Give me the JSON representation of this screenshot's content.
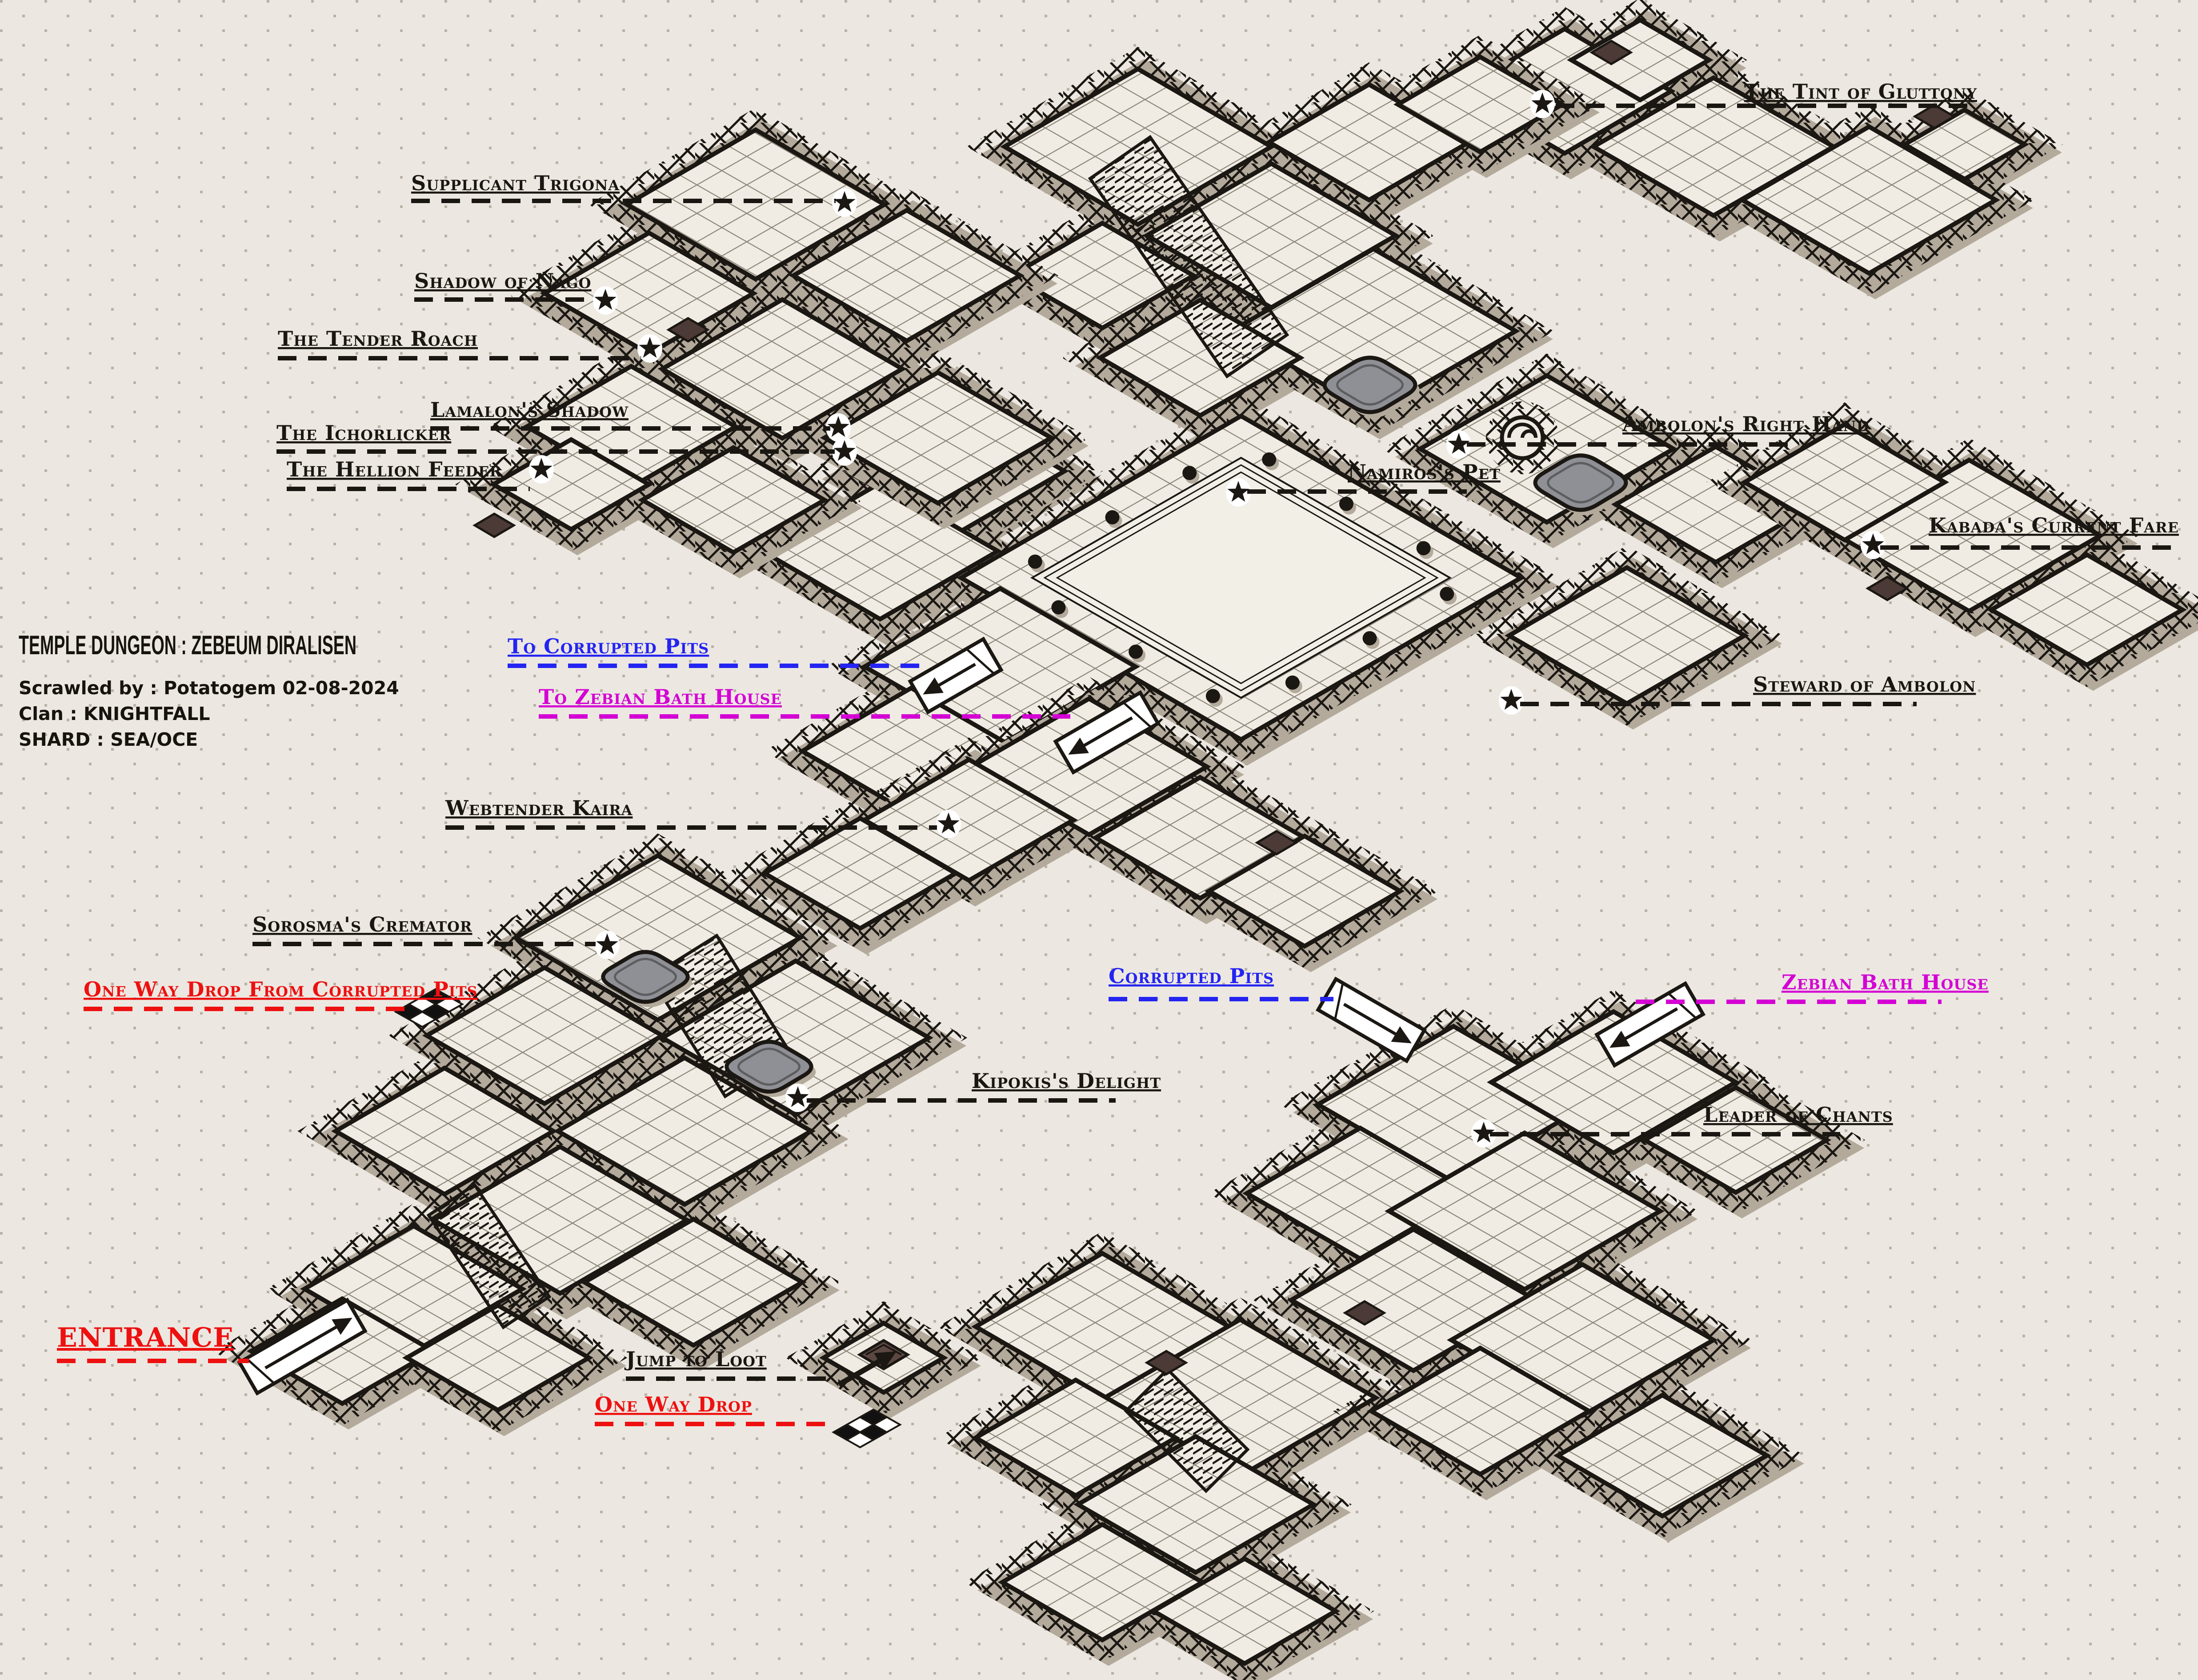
{
  "title_block": {
    "title": "TEMPLE DUNGEON : ZEBEUM DIRALISEN",
    "scrawled_by": "Scrawled by : Potatogem 02-08-2024",
    "clan": "Clan : KNIGHTFALL",
    "shard": "SHARD : SEA/OCE"
  },
  "colors": {
    "background": "#ece8e1",
    "floor": "#f0ece3",
    "ink": "#1b1713",
    "wall_shadow": "#b3aa9c",
    "pool_gray": "#8f9095",
    "label_black": "#1a1612",
    "label_red": "#ee1010",
    "label_blue": "#2424f2",
    "label_magenta": "#d400d4"
  },
  "labels": [
    {
      "id": "tint-of-gluttony",
      "text": "The Tint of Gluttony",
      "color": "#1a1612",
      "marker": "star"
    },
    {
      "id": "supplicant-trigona",
      "text": "Supplicant Trigona",
      "color": "#1a1612",
      "marker": "star"
    },
    {
      "id": "shadow-of-nago",
      "text": "Shadow of Nago",
      "color": "#1a1612",
      "marker": "star"
    },
    {
      "id": "tender-roach",
      "text": "The Tender Roach",
      "color": "#1a1612",
      "marker": "star"
    },
    {
      "id": "lamalons-shadow",
      "text": "Lamalon's Shadow",
      "color": "#1a1612",
      "marker": "star"
    },
    {
      "id": "ichorlicker",
      "text": "The Ichorlicker",
      "color": "#1a1612",
      "marker": "star"
    },
    {
      "id": "hellion-feeder",
      "text": "The Hellion Feeder",
      "color": "#1a1612",
      "marker": "star"
    },
    {
      "id": "ambolons-right-hand",
      "text": "Ambolon's Right Hand",
      "color": "#1a1612",
      "marker": "star"
    },
    {
      "id": "namiross-pet",
      "text": "Namiros's Pet",
      "color": "#1a1612",
      "marker": "star"
    },
    {
      "id": "kabadas-current-fare",
      "text": "Kabada's Current Fare",
      "color": "#1a1612",
      "marker": "star"
    },
    {
      "id": "to-corrupted-pits",
      "text": "To Corrupted Pits",
      "color": "#2424f2",
      "marker": "white-arrow"
    },
    {
      "id": "to-zebian-bath-house",
      "text": "To Zebian Bath House",
      "color": "#d400d4",
      "marker": "white-arrow"
    },
    {
      "id": "steward-of-ambolon",
      "text": "Steward of Ambolon",
      "color": "#1a1612",
      "marker": "star"
    },
    {
      "id": "webtender-kaira",
      "text": "Webtender Kaira",
      "color": "#1a1612",
      "marker": "star"
    },
    {
      "id": "sorosmas-cremator",
      "text": "Sorosma's Cremator",
      "color": "#1a1612",
      "marker": "star"
    },
    {
      "id": "one-way-drop-from-corrupted-pits",
      "text": "One Way Drop From Corrupted Pits",
      "color": "#ee1010",
      "marker": "checker-drop"
    },
    {
      "id": "corrupted-pits",
      "text": "Corrupted Pits",
      "color": "#2424f2",
      "marker": "white-arrow"
    },
    {
      "id": "zebian-bath-house",
      "text": "Zebian Bath House",
      "color": "#d400d4",
      "marker": "white-arrow"
    },
    {
      "id": "kipokiss-delight",
      "text": "Kipokis's Delight",
      "color": "#1a1612",
      "marker": "star"
    },
    {
      "id": "leader-of-chants",
      "text": "Leader of Chants",
      "color": "#1a1612",
      "marker": "star"
    },
    {
      "id": "entrance",
      "text": "ENTRANCE",
      "color": "#ee1010",
      "marker": "white-arrow"
    },
    {
      "id": "jump-to-loot",
      "text": "Jump to Loot",
      "color": "#1a1612",
      "marker": "black-arrow"
    },
    {
      "id": "one-way-drop",
      "text": "One Way Drop",
      "color": "#ee1010",
      "marker": "checker-drop"
    }
  ]
}
